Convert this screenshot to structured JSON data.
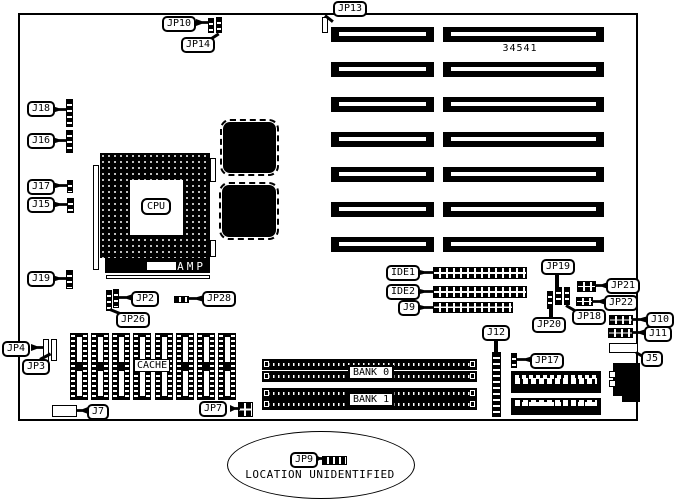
{
  "diagram": {
    "kind": "motherboard jumper and connector location diagram",
    "part_number": "34541",
    "note": "LOCATION UNIDENTIFIED"
  },
  "colors": {
    "ink": "#000000",
    "paper": "#ffffff"
  },
  "labels": {
    "jp13": "JP13",
    "jp10": "JP10",
    "jp14": "JP14",
    "j18": "J18",
    "j16": "J16",
    "j17": "J17",
    "j15": "J15",
    "j19": "J19",
    "jp2": "JP2",
    "jp26": "JP26",
    "jp28": "JP28",
    "jp4": "JP4",
    "jp3": "JP3",
    "j7": "J7",
    "jp7": "JP7",
    "ide1": "IDE1",
    "ide2": "IDE2",
    "j9": "J9",
    "jp19": "JP19",
    "jp20": "JP20",
    "jp18": "JP18",
    "jp21": "JP21",
    "jp22": "JP22",
    "j10": "J10",
    "j11": "J11",
    "j5": "J5",
    "j12": "J12",
    "jp17": "JP17",
    "jp9": "JP9"
  },
  "texts": {
    "cpu": "CPU",
    "amp": "AMP",
    "cache": "CACHE",
    "bank0": "BANK 0",
    "bank1": "BANK 1",
    "part_number": "34541",
    "location_note": "LOCATION UNIDENTIFIED"
  }
}
